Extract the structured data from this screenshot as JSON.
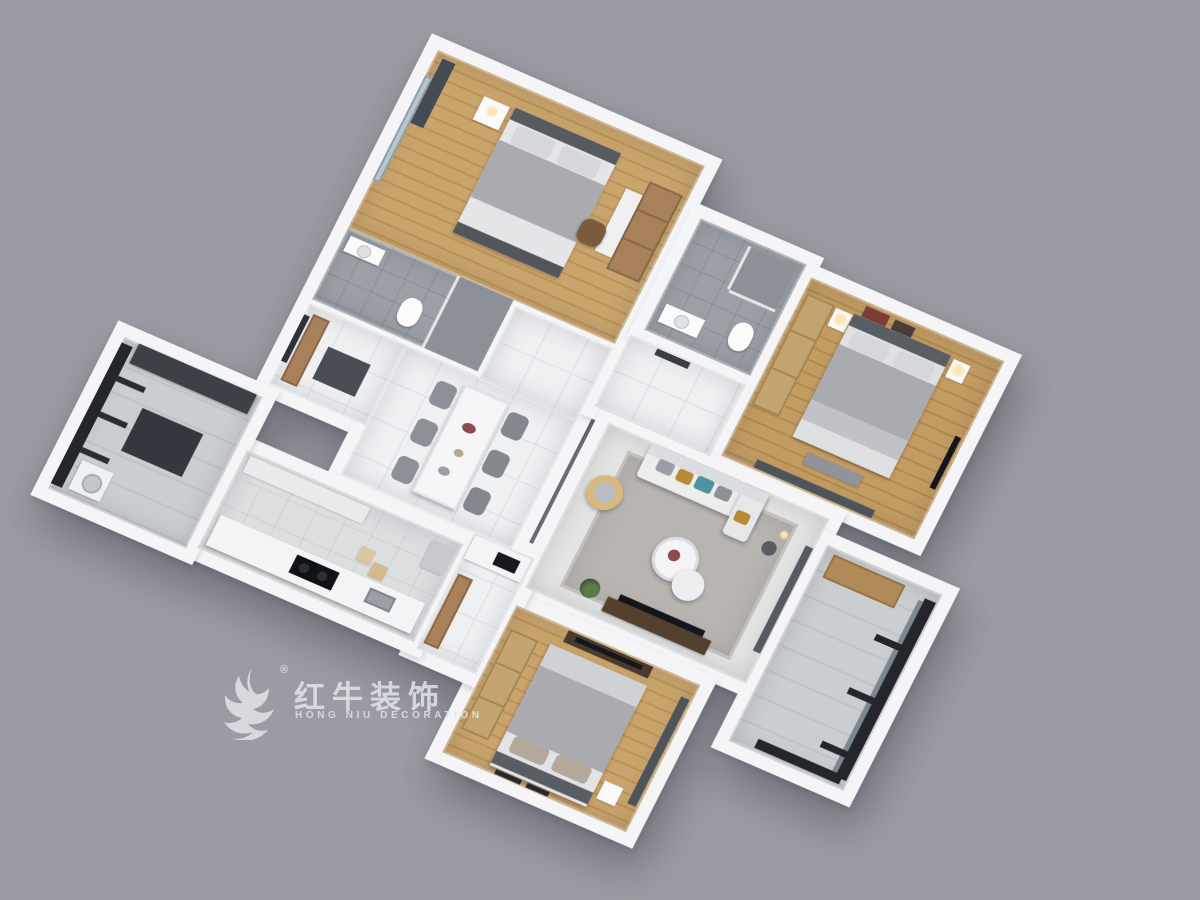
{
  "scene": {
    "description": "3D top-down axonometric render of a three-bedroom apartment floor plan on a plain gray backdrop",
    "background": "#9b9ba3",
    "plan_rotation_deg": 23
  },
  "watermark": {
    "logo": "bull-swoosh-icon",
    "registered_mark": "®",
    "brand_cn": "红牛装饰",
    "brand_en": "HONG NIU DECORATION"
  },
  "palette": {
    "wall": "#f5f5f7",
    "wood": "#c9a46c",
    "wood_dark": "#bb9357",
    "tile": "#eef0f2",
    "tile_line": "#dcdee3",
    "gray_tile": "#9aa0a6",
    "gray_tile_dark": "#8b9197",
    "rug": "#b8b5b1",
    "bedding": "#a9abb1",
    "pillow": "#d6d7da",
    "headboard": "#565a61",
    "cabinet": "#a8805a",
    "wardrobe": "#c3a36f",
    "frame": "#23262b",
    "curtain": "#4d545c",
    "sofa": "#ededee",
    "teal": "#4f93a0",
    "mustard": "#b98a33",
    "tv": "#141619",
    "tv_cabinet": "#54402f",
    "plant": "#5d7a4a",
    "counter": "#f3f4f5",
    "cooktop": "#101214",
    "watermark": "rgba(226,228,234,0.85)"
  },
  "rooms": [
    {
      "id": "bedroom-north",
      "label": "bedroom with study corner",
      "floor": "wood",
      "items": [
        "window",
        "curtain",
        "bed",
        "nightstand",
        "desk",
        "bookshelf",
        "office-chair"
      ]
    },
    {
      "id": "bathroom-shared",
      "label": "shared bathroom",
      "floor": "gray-tile",
      "items": [
        "shower",
        "glass-partition",
        "toilet",
        "vanity"
      ]
    },
    {
      "id": "pantry",
      "label": "pantry / storage nook",
      "floor": "tile",
      "items": [
        "tall-cabinet",
        "window",
        "mat"
      ]
    },
    {
      "id": "hall-north",
      "label": "hallway",
      "floor": "tile",
      "items": []
    },
    {
      "id": "dining",
      "label": "dining room",
      "floor": "tile",
      "items": [
        "dining-table",
        "dining-chairs-x6",
        "table-decor"
      ]
    },
    {
      "id": "hall-east",
      "label": "entry hallway",
      "floor": "tile",
      "items": [
        "wall-picture"
      ]
    },
    {
      "id": "bathroom-master",
      "label": "master bathroom",
      "floor": "gray-tile",
      "items": [
        "shower",
        "glass-partition",
        "toilet",
        "vanity"
      ]
    },
    {
      "id": "bedroom-master",
      "label": "master bedroom",
      "floor": "wood",
      "items": [
        "wardrobe",
        "art-frames",
        "bed",
        "nightstand-lamps",
        "wall-tv",
        "bench",
        "curtain"
      ]
    },
    {
      "id": "living",
      "label": "living room",
      "floor": "tile",
      "items": [
        "rug",
        "sofa",
        "throw-pillows",
        "coffee-tables",
        "armchair",
        "side-table",
        "floor-lamp",
        "tv-cabinet",
        "tv",
        "plant",
        "curtain"
      ]
    },
    {
      "id": "balcony-east",
      "label": "living room balcony",
      "floor": "tile",
      "items": [
        "black-frame-windows",
        "wood-cabinet"
      ]
    },
    {
      "id": "bedroom-south",
      "label": "south bedroom",
      "floor": "wood",
      "items": [
        "wardrobe",
        "bed",
        "nightstand",
        "tv-cabinet",
        "art-frames",
        "curtain"
      ]
    },
    {
      "id": "corridor-south",
      "label": "service corridor",
      "floor": "tile",
      "items": [
        "counter-with-sink",
        "cabinet"
      ]
    },
    {
      "id": "kitchen",
      "label": "galley kitchen",
      "floor": "tile",
      "items": [
        "upper-cabinets",
        "counter",
        "cooktop",
        "sink",
        "stools",
        "fridge"
      ]
    },
    {
      "id": "balcony-west",
      "label": "utility balcony",
      "floor": "tile",
      "items": [
        "black-frame-windows",
        "dark-counter",
        "washer",
        "mat"
      ]
    }
  ]
}
